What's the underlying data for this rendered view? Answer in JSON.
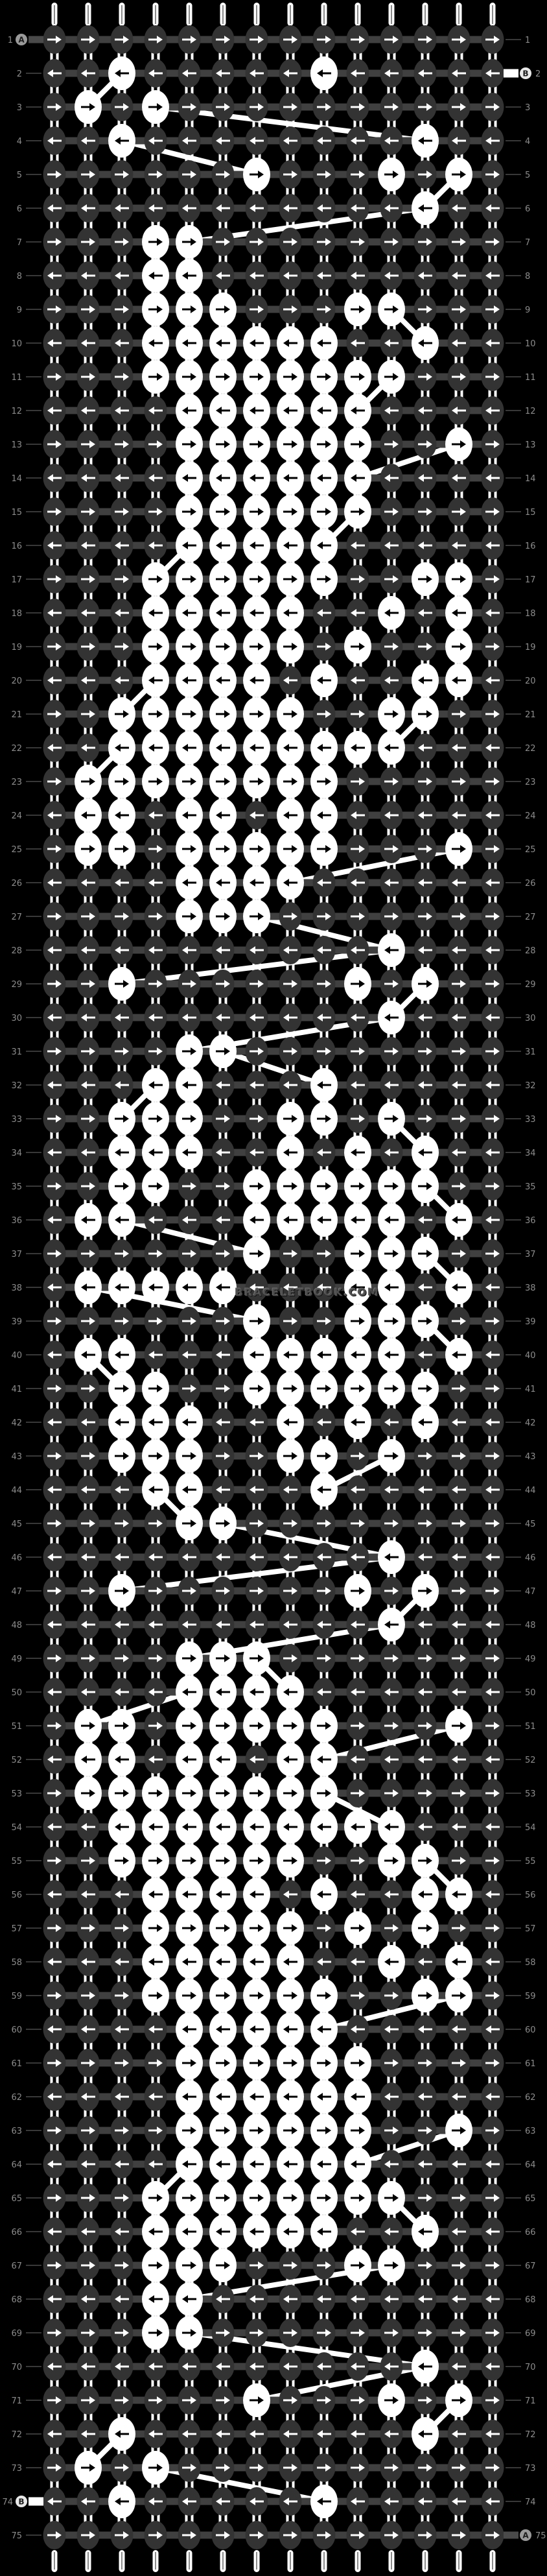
{
  "app": {
    "type": "alpha-bracelet-pattern-chart",
    "watermark_text": "BRACELETBOOK.COM"
  },
  "grid": {
    "cols": 14,
    "rows": 75,
    "col_start": 84,
    "col_step": 52,
    "row_start": 61,
    "row_step": 52,
    "odd_row_arrow": "right",
    "even_row_arrow": "left"
  },
  "colors": {
    "background": "#000000",
    "cell_dark": "#333333",
    "cell_highlight": "#ffffff",
    "connector": "#404040",
    "strand_connector": "#ffffff",
    "yarn_line": "#ffffff",
    "row_number": "#8c8c8c",
    "leader_line": "#6f6f6f",
    "marker_a_disc": "#9a9a9a",
    "marker_b_disc": "#e8e8e8",
    "marker_letter": "#1d1d1d",
    "stub_a": "#4a4a4a",
    "stub_b": "#ffffff",
    "tail": "#ffffff",
    "tail_seam": "#8a8a8a"
  },
  "markers": [
    {
      "row": 1,
      "side": "left",
      "label": "A",
      "style": "a"
    },
    {
      "row": 2,
      "side": "right",
      "label": "B",
      "style": "b"
    },
    {
      "row": 74,
      "side": "left",
      "label": "B",
      "style": "b"
    },
    {
      "row": 75,
      "side": "right",
      "label": "A",
      "style": "a"
    }
  ],
  "row_numbers": [
    "1",
    "2",
    "3",
    "4",
    "5",
    "6",
    "7",
    "8",
    "9",
    "10",
    "11",
    "12",
    "13",
    "14",
    "15",
    "16",
    "17",
    "18",
    "19",
    "20",
    "21",
    "22",
    "23",
    "24",
    "25",
    "26",
    "27",
    "28",
    "29",
    "30",
    "31",
    "32",
    "33",
    "34",
    "35",
    "36",
    "37",
    "38",
    "39",
    "40",
    "41",
    "42",
    "43",
    "44",
    "45",
    "46",
    "47",
    "48",
    "49",
    "50",
    "51",
    "52",
    "53",
    "54",
    "55",
    "56",
    "57",
    "58",
    "59",
    "60",
    "61",
    "62",
    "63",
    "64",
    "65",
    "66",
    "67",
    "68",
    "69",
    "70",
    "71",
    "72",
    "73",
    "74",
    "75"
  ],
  "highlight_cells": {
    "1": [],
    "2": [
      3,
      9
    ],
    "3": [
      2,
      4
    ],
    "4": [
      3,
      12
    ],
    "5": [
      7,
      11,
      13
    ],
    "6": [
      12
    ],
    "7": [
      4,
      5
    ],
    "8": [
      4,
      5
    ],
    "9": [
      4,
      5,
      6,
      10,
      11
    ],
    "10": [
      4,
      5,
      6,
      7,
      8,
      9,
      12
    ],
    "11": [
      4,
      5,
      6,
      7,
      8,
      9,
      10,
      11
    ],
    "12": [
      5,
      6,
      7,
      8,
      9,
      10
    ],
    "13": [
      5,
      6,
      7,
      8,
      9,
      10,
      13
    ],
    "14": [
      5,
      6,
      7,
      8,
      9,
      10
    ],
    "15": [
      5,
      6,
      7,
      8,
      9,
      10
    ],
    "16": [
      5,
      6,
      7,
      8,
      9
    ],
    "17": [
      4,
      5,
      6,
      7,
      8,
      9,
      12,
      13
    ],
    "18": [
      4,
      5,
      6,
      7,
      8,
      11,
      13
    ],
    "19": [
      4,
      5,
      6,
      7,
      8,
      10,
      13
    ],
    "20": [
      4,
      5,
      6,
      7,
      9,
      12,
      13
    ],
    "21": [
      3,
      4,
      5,
      6,
      7,
      8,
      11,
      12
    ],
    "22": [
      3,
      4,
      5,
      6,
      7,
      8,
      9,
      10,
      11
    ],
    "23": [
      2,
      3,
      4,
      5,
      6,
      7,
      8,
      9
    ],
    "24": [
      2,
      3,
      5,
      6,
      8,
      9
    ],
    "25": [
      2,
      3,
      5,
      6,
      7,
      8,
      9,
      13
    ],
    "26": [
      5,
      6,
      7,
      8
    ],
    "27": [
      5,
      6,
      7
    ],
    "28": [
      11
    ],
    "29": [
      3,
      10,
      12
    ],
    "30": [
      11
    ],
    "31": [
      5,
      6
    ],
    "32": [
      4,
      5,
      9
    ],
    "33": [
      3,
      4,
      5,
      8,
      9,
      11
    ],
    "34": [
      3,
      4,
      5,
      8,
      10,
      12
    ],
    "35": [
      3,
      4,
      7,
      8,
      9,
      10,
      11,
      12
    ],
    "36": [
      2,
      3,
      7,
      8,
      9,
      10,
      11,
      13
    ],
    "37": [
      7,
      10,
      11,
      12
    ],
    "38": [
      2,
      3,
      4,
      5,
      6,
      10,
      11,
      13
    ],
    "39": [
      7,
      10,
      11,
      12
    ],
    "40": [
      2,
      3,
      7,
      8,
      9,
      10,
      11,
      13
    ],
    "41": [
      3,
      4,
      7,
      8,
      9,
      10,
      11,
      12
    ],
    "42": [
      3,
      4,
      5,
      8,
      10,
      12
    ],
    "43": [
      3,
      4,
      5,
      8,
      9,
      11
    ],
    "44": [
      4,
      5,
      9
    ],
    "45": [
      5,
      6
    ],
    "46": [
      11
    ],
    "47": [
      3,
      10,
      12
    ],
    "48": [
      11
    ],
    "49": [
      5,
      6,
      7
    ],
    "50": [
      5,
      6,
      7,
      8
    ],
    "51": [
      2,
      3,
      5,
      6,
      7,
      8,
      9,
      13
    ],
    "52": [
      2,
      3,
      5,
      6,
      8,
      9
    ],
    "53": [
      2,
      3,
      4,
      5,
      6,
      7,
      8,
      9
    ],
    "54": [
      3,
      4,
      5,
      6,
      7,
      8,
      9,
      10,
      11
    ],
    "55": [
      3,
      4,
      5,
      6,
      7,
      8,
      11,
      12
    ],
    "56": [
      4,
      5,
      6,
      7,
      9,
      12,
      13
    ],
    "57": [
      4,
      5,
      6,
      7,
      8,
      10,
      12
    ],
    "58": [
      4,
      5,
      6,
      7,
      8,
      11,
      13
    ],
    "59": [
      4,
      5,
      6,
      7,
      8,
      9,
      12,
      13
    ],
    "60": [
      5,
      6,
      7,
      8,
      9
    ],
    "61": [
      5,
      6,
      7,
      8,
      9,
      10
    ],
    "62": [
      5,
      6,
      7,
      8,
      9,
      10
    ],
    "63": [
      5,
      6,
      7,
      8,
      9,
      10,
      13
    ],
    "64": [
      5,
      6,
      7,
      8,
      9,
      10
    ],
    "65": [
      4,
      5,
      6,
      7,
      8,
      9,
      10,
      11
    ],
    "66": [
      4,
      5,
      6,
      7,
      8,
      9,
      12
    ],
    "67": [
      4,
      5,
      6,
      10,
      11
    ],
    "68": [
      4,
      5
    ],
    "69": [
      4,
      5
    ],
    "70": [
      12
    ],
    "71": [
      7,
      11,
      13
    ],
    "72": [
      3,
      12
    ],
    "73": [
      2,
      4
    ],
    "74": [
      3,
      9
    ],
    "75": []
  },
  "yarn_links": [
    [
      2,
      3,
      3,
      2
    ],
    [
      3,
      4,
      4,
      12
    ],
    [
      4,
      3,
      5,
      7
    ],
    [
      5,
      13,
      6,
      12
    ],
    [
      6,
      12,
      7,
      5
    ],
    [
      9,
      11,
      10,
      12
    ],
    [
      11,
      11,
      12,
      10
    ],
    [
      13,
      13,
      14,
      10
    ],
    [
      15,
      10,
      16,
      9
    ],
    [
      16,
      5,
      17,
      4
    ],
    [
      20,
      4,
      21,
      3
    ],
    [
      21,
      12,
      22,
      11
    ],
    [
      22,
      3,
      23,
      2
    ],
    [
      25,
      13,
      26,
      8
    ],
    [
      27,
      7,
      28,
      11
    ],
    [
      28,
      11,
      29,
      3
    ],
    [
      29,
      12,
      30,
      11
    ],
    [
      30,
      11,
      31,
      5
    ],
    [
      31,
      6,
      32,
      9
    ],
    [
      32,
      4,
      33,
      3
    ],
    [
      33,
      11,
      34,
      12
    ],
    [
      35,
      12,
      36,
      13
    ],
    [
      36,
      3,
      37,
      7
    ],
    [
      37,
      12,
      38,
      13
    ],
    [
      38,
      2,
      39,
      7
    ],
    [
      39,
      12,
      40,
      13
    ],
    [
      40,
      2,
      41,
      3
    ],
    [
      43,
      11,
      44,
      9
    ],
    [
      44,
      4,
      45,
      5
    ],
    [
      45,
      6,
      46,
      11
    ],
    [
      46,
      11,
      47,
      3
    ],
    [
      47,
      12,
      48,
      11
    ],
    [
      48,
      11,
      49,
      5
    ],
    [
      49,
      7,
      50,
      8
    ],
    [
      50,
      5,
      51,
      2
    ],
    [
      51,
      13,
      52,
      9
    ],
    [
      53,
      9,
      54,
      11
    ],
    [
      55,
      12,
      56,
      13
    ],
    [
      59,
      13,
      60,
      9
    ],
    [
      63,
      13,
      64,
      10
    ],
    [
      64,
      5,
      65,
      4
    ],
    [
      65,
      11,
      66,
      12
    ],
    [
      67,
      11,
      68,
      5
    ],
    [
      69,
      5,
      70,
      12
    ],
    [
      70,
      12,
      71,
      7
    ],
    [
      71,
      13,
      72,
      12
    ],
    [
      72,
      3,
      73,
      2
    ],
    [
      73,
      4,
      74,
      9
    ]
  ]
}
